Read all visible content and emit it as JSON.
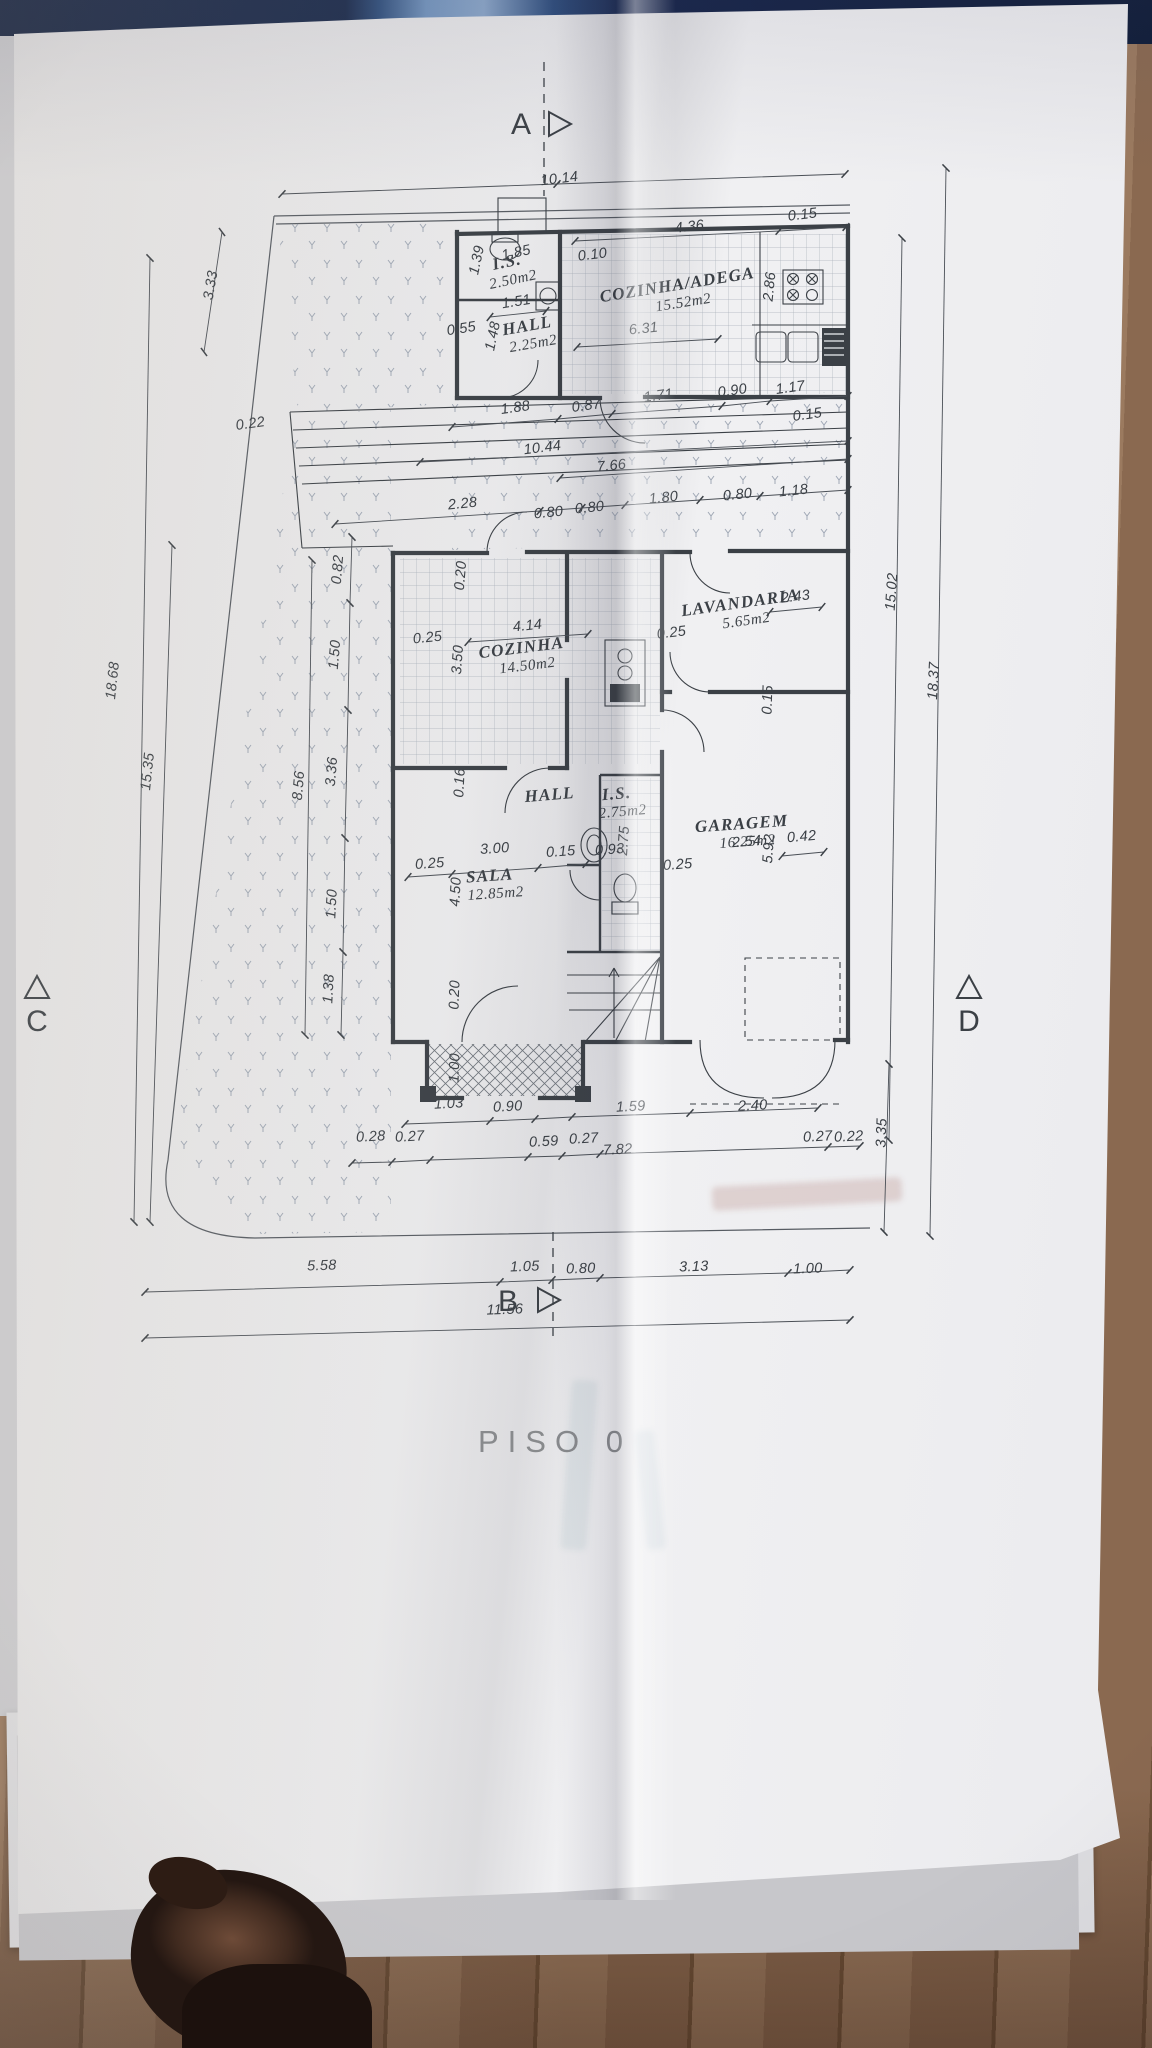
{
  "colors": {
    "ink": "#3b4046",
    "titlegray": "#87898c",
    "paper": "#e9e9eb",
    "strip-navy": "#16233f",
    "strip-lightblue": "#8aa6c9",
    "wood1": "#9b7a5f",
    "wood2": "#8a6950",
    "wood3": "#6f5239"
  },
  "plan": {
    "title": "PISO  0",
    "markers": [
      {
        "label": "A",
        "lx": 521,
        "ly": 134,
        "type": "right",
        "tx": 549,
        "ty": 124,
        "line": [
          544,
          62,
          544,
          196
        ]
      },
      {
        "label": "B",
        "lx": 508,
        "ly": 1311,
        "type": "right",
        "tx": 538,
        "ty": 1300,
        "line": [
          553,
          1232,
          553,
          1336
        ]
      },
      {
        "label": "C",
        "lx": 37,
        "ly": 1031,
        "type": "up",
        "tx": 37,
        "ty": 988,
        "line": null
      },
      {
        "label": "D",
        "lx": 969,
        "ly": 1031,
        "type": "up",
        "tx": 969,
        "ty": 988,
        "line": null
      }
    ],
    "rooms": [
      {
        "name": "I.S.",
        "area": "2.50m2",
        "x": 508,
        "y": 267,
        "r": -12
      },
      {
        "name": "HALL",
        "area": "2.25m2",
        "x": 528,
        "y": 331,
        "r": -10
      },
      {
        "name": "COZINHA/ADEGA",
        "area": "15.52m2",
        "x": 678,
        "y": 290,
        "r": -9
      },
      {
        "name": "LAVANDARIA",
        "area": "5.65m2",
        "x": 741,
        "y": 608,
        "r": -8
      },
      {
        "name": "COZINHA",
        "area": "14.50m2",
        "x": 522,
        "y": 653,
        "r": -7
      },
      {
        "name": "HALL",
        "area": "",
        "x": 550,
        "y": 800,
        "r": -5
      },
      {
        "name": "I.S.",
        "area": "2.75m2",
        "x": 617,
        "y": 799,
        "r": -5
      },
      {
        "name": "SALA",
        "area": "12.85m2",
        "x": 490,
        "y": 881,
        "r": -4
      },
      {
        "name": "GARAGEM",
        "area": "16.25m2",
        "x": 742,
        "y": 829,
        "r": -4
      }
    ],
    "dimensions": [
      {
        "t": "10.14",
        "x": 560,
        "y": 183,
        "r": -7
      },
      {
        "t": "4.36",
        "x": 690,
        "y": 231,
        "r": -7
      },
      {
        "t": "0.15",
        "x": 803,
        "y": 219,
        "r": -7
      },
      {
        "t": "0.10",
        "x": 593,
        "y": 259,
        "r": -7
      },
      {
        "t": "2.86",
        "x": 774,
        "y": 287,
        "r": -84
      },
      {
        "t": "6.31",
        "x": 644,
        "y": 333,
        "r": -6
      },
      {
        "t": "1.39",
        "x": 481,
        "y": 261,
        "r": -78
      },
      {
        "t": "1.85",
        "x": 517,
        "y": 257,
        "r": -12
      },
      {
        "t": "1.51",
        "x": 517,
        "y": 306,
        "r": -9
      },
      {
        "t": "0.55",
        "x": 462,
        "y": 333,
        "r": -9
      },
      {
        "t": "1.48",
        "x": 497,
        "y": 337,
        "r": -78
      },
      {
        "t": "1.88",
        "x": 516,
        "y": 412,
        "r": -8
      },
      {
        "t": "0.87",
        "x": 587,
        "y": 410,
        "r": -8
      },
      {
        "t": "1.71",
        "x": 659,
        "y": 400,
        "r": -8
      },
      {
        "t": "0.90",
        "x": 733,
        "y": 395,
        "r": -8
      },
      {
        "t": "1.17",
        "x": 791,
        "y": 392,
        "r": -8
      },
      {
        "t": "0.15",
        "x": 808,
        "y": 419,
        "r": -8
      },
      {
        "t": "10.44",
        "x": 543,
        "y": 452,
        "r": -7
      },
      {
        "t": "7.66",
        "x": 612,
        "y": 470,
        "r": -6
      },
      {
        "t": "2.28",
        "x": 463,
        "y": 508,
        "r": -6
      },
      {
        "t": "0.80",
        "x": 549,
        "y": 517,
        "r": -6
      },
      {
        "t": "0.80",
        "x": 590,
        "y": 512,
        "r": -6
      },
      {
        "t": "1.80",
        "x": 664,
        "y": 502,
        "r": -6
      },
      {
        "t": "0.80",
        "x": 738,
        "y": 499,
        "r": -6
      },
      {
        "t": "1.18",
        "x": 794,
        "y": 495,
        "r": -6
      },
      {
        "t": "3.33",
        "x": 215,
        "y": 286,
        "r": -80
      },
      {
        "t": "0.22",
        "x": 251,
        "y": 428,
        "r": -8
      },
      {
        "t": "18.68",
        "x": 117,
        "y": 681,
        "r": -84
      },
      {
        "t": "15.35",
        "x": 152,
        "y": 772,
        "r": -84
      },
      {
        "t": "8.56",
        "x": 303,
        "y": 786,
        "r": -85
      },
      {
        "t": "3.36",
        "x": 336,
        "y": 772,
        "r": -85
      },
      {
        "t": "1.50",
        "x": 339,
        "y": 655,
        "r": -85
      },
      {
        "t": "0.82",
        "x": 342,
        "y": 570,
        "r": -85
      },
      {
        "t": "1.50",
        "x": 336,
        "y": 904,
        "r": -87
      },
      {
        "t": "1.38",
        "x": 333,
        "y": 989,
        "r": -87
      },
      {
        "t": "0.20",
        "x": 465,
        "y": 576,
        "r": -85
      },
      {
        "t": "0.25",
        "x": 428,
        "y": 642,
        "r": -6
      },
      {
        "t": "3.50",
        "x": 462,
        "y": 660,
        "r": -86
      },
      {
        "t": "4.14",
        "x": 528,
        "y": 630,
        "r": -6
      },
      {
        "t": "0.16",
        "x": 464,
        "y": 783,
        "r": -87
      },
      {
        "t": "0.25",
        "x": 430,
        "y": 868,
        "r": -4
      },
      {
        "t": "3.00",
        "x": 495,
        "y": 853,
        "r": -4
      },
      {
        "t": "0.15",
        "x": 561,
        "y": 856,
        "r": -4
      },
      {
        "t": "4.50",
        "x": 460,
        "y": 892,
        "r": -87
      },
      {
        "t": "0.93",
        "x": 610,
        "y": 854,
        "r": -4
      },
      {
        "t": "2.75",
        "x": 628,
        "y": 841,
        "r": -86
      },
      {
        "t": "0.25",
        "x": 678,
        "y": 869,
        "r": -4
      },
      {
        "t": "2.43",
        "x": 796,
        "y": 601,
        "r": -7
      },
      {
        "t": "0.25",
        "x": 672,
        "y": 637,
        "r": -7
      },
      {
        "t": "0.15",
        "x": 772,
        "y": 700,
        "r": -88
      },
      {
        "t": "2.54",
        "x": 747,
        "y": 846,
        "r": -5
      },
      {
        "t": "5.92",
        "x": 773,
        "y": 849,
        "r": -86
      },
      {
        "t": "0.42",
        "x": 802,
        "y": 841,
        "r": -5
      },
      {
        "t": "15.02",
        "x": 896,
        "y": 592,
        "r": -86
      },
      {
        "t": "18.37",
        "x": 938,
        "y": 681,
        "r": -87
      },
      {
        "t": "0.20",
        "x": 459,
        "y": 995,
        "r": -88
      },
      {
        "t": "1.00",
        "x": 459,
        "y": 1068,
        "r": -88
      },
      {
        "t": "3.35",
        "x": 886,
        "y": 1133,
        "r": -88
      },
      {
        "t": "1.03",
        "x": 449,
        "y": 1108,
        "r": -3
      },
      {
        "t": "0.90",
        "x": 508,
        "y": 1111,
        "r": -3
      },
      {
        "t": "1.59",
        "x": 631,
        "y": 1111,
        "r": -3
      },
      {
        "t": "2.40",
        "x": 753,
        "y": 1110,
        "r": -3
      },
      {
        "t": "0.28",
        "x": 371,
        "y": 1141,
        "r": -3
      },
      {
        "t": "0.27",
        "x": 410,
        "y": 1141,
        "r": -3
      },
      {
        "t": "0.59",
        "x": 544,
        "y": 1146,
        "r": -3
      },
      {
        "t": "0.27",
        "x": 584,
        "y": 1143,
        "r": -3
      },
      {
        "t": "7.82",
        "x": 618,
        "y": 1154,
        "r": -3
      },
      {
        "t": "0.27",
        "x": 818,
        "y": 1141,
        "r": -3
      },
      {
        "t": "0.22",
        "x": 849,
        "y": 1141,
        "r": -3
      },
      {
        "t": "5.58",
        "x": 322,
        "y": 1270,
        "r": -2
      },
      {
        "t": "1.05",
        "x": 525,
        "y": 1271,
        "r": -2
      },
      {
        "t": "0.80",
        "x": 581,
        "y": 1273,
        "r": -2
      },
      {
        "t": "3.13",
        "x": 694,
        "y": 1271,
        "r": -2
      },
      {
        "t": "1.00",
        "x": 808,
        "y": 1273,
        "r": -2
      },
      {
        "t": "11.56",
        "x": 505,
        "y": 1314,
        "r": -2
      }
    ]
  }
}
